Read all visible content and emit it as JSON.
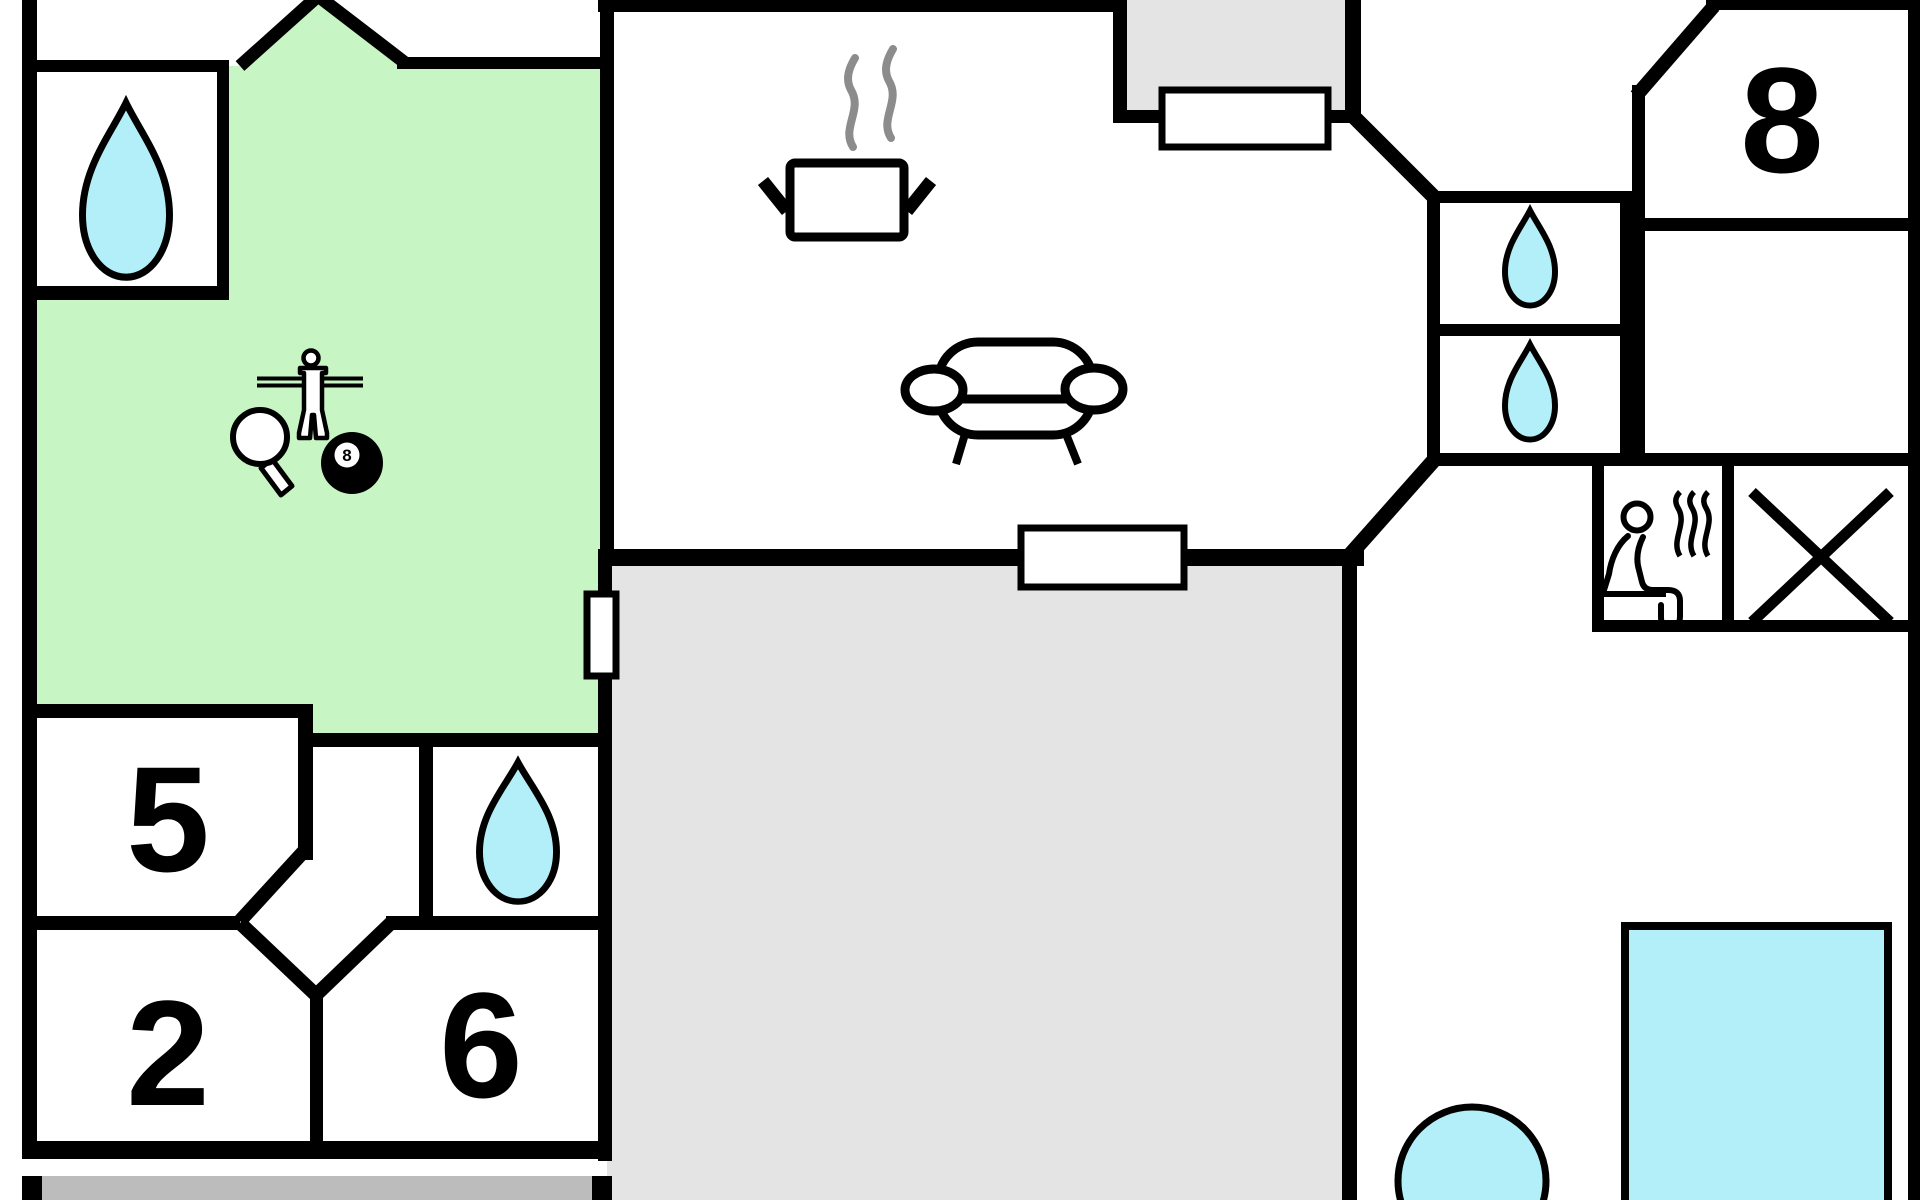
{
  "floorplan": {
    "rooms": {
      "room5": {
        "label": "5"
      },
      "room2": {
        "label": "2"
      },
      "room6": {
        "label": "6"
      },
      "room8": {
        "label": "8"
      }
    },
    "game_room": {
      "billiard_ball_label": "8"
    },
    "colors": {
      "wall": "#000000",
      "room_green": "#c7f6c4",
      "water_cyan": "#b2eff8",
      "area_gray": "#e4e4e4",
      "terrace_gray": "#bcbcbc",
      "steam_gray": "#8c8c8c"
    },
    "icons": {
      "water_drop": "teardrop",
      "cooking_pot": "pot with steam",
      "sofa": "couch",
      "foosball_player": "table-football figure on rods",
      "table_tennis_paddle": "paddle",
      "billiard_ball": "8-ball",
      "sauna": "person on sauna bench with steam",
      "no_access_cross": "X",
      "pool": "rectangular pool",
      "hot_tub": "round tub"
    }
  }
}
